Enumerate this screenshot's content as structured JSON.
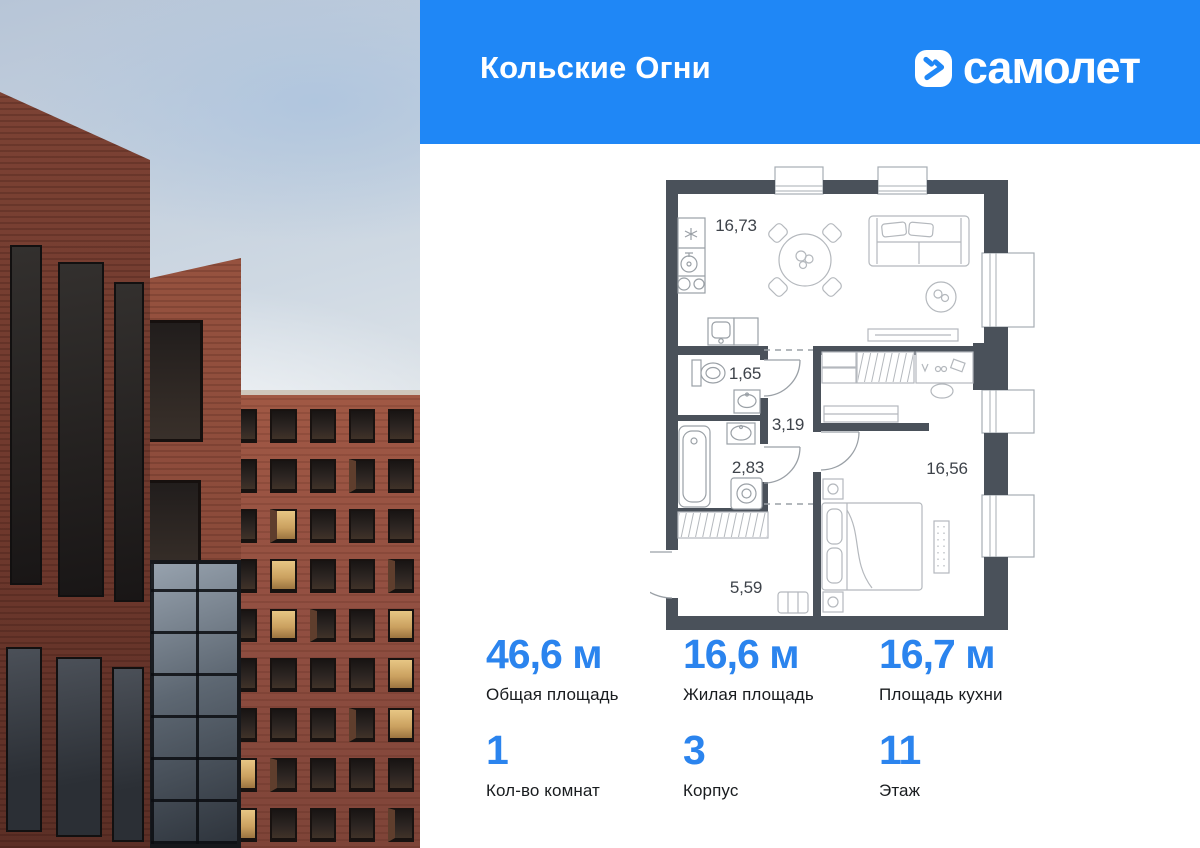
{
  "header": {
    "project_title": "Кольские Огни",
    "brand_name": "самолет"
  },
  "floor_plan": {
    "rooms": {
      "kitchen_living": "16,73",
      "wc": "1,65",
      "hallway": "3,19",
      "bathroom": "2,83",
      "bedroom": "16,56",
      "entry_hall": "5,59"
    }
  },
  "stats": {
    "cells": [
      {
        "value": "46,6 м",
        "label": "Общая площадь"
      },
      {
        "value": "16,6 м",
        "label": "Жилая площадь"
      },
      {
        "value": "16,7 м",
        "label": "Площадь кухни"
      },
      {
        "value": "1",
        "label": "Кол-во комнат"
      },
      {
        "value": "3",
        "label": "Корпус"
      },
      {
        "value": "11",
        "label": "Этаж"
      }
    ]
  },
  "colors": {
    "brand_blue": "#1f87f6",
    "stat_blue": "#2b84ee",
    "wall": "#4a515a"
  }
}
